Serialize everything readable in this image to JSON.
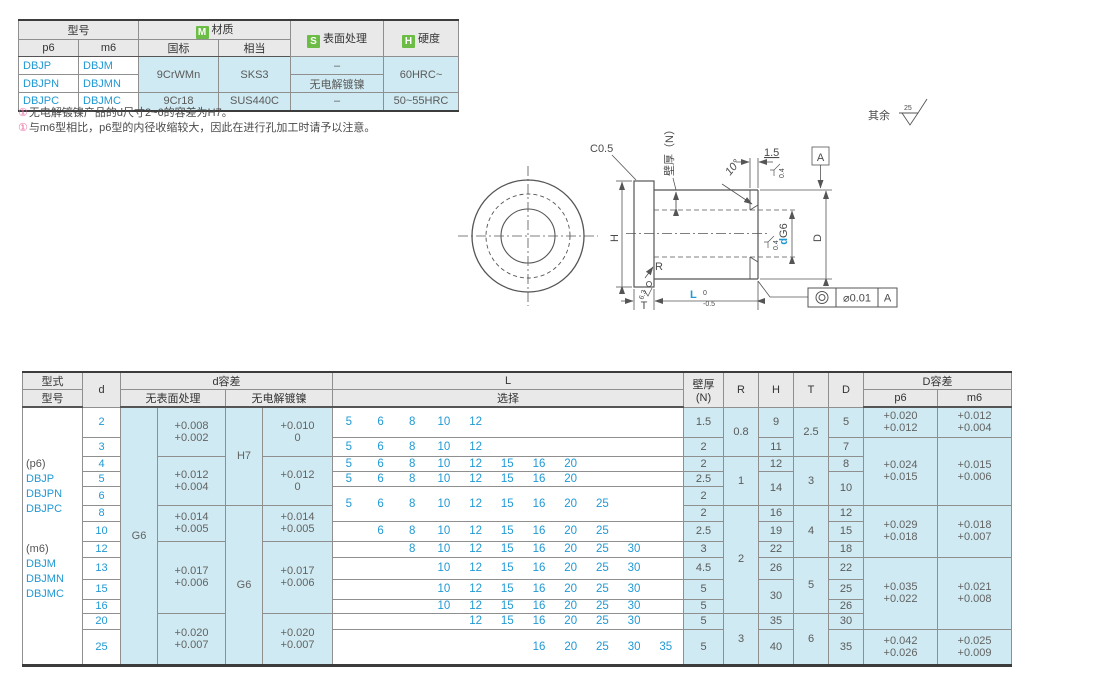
{
  "top_table": {
    "headers": {
      "model": "型号",
      "p6": "p6",
      "m6": "m6",
      "material_badge": "M",
      "material": "材质",
      "gb": "国标",
      "equiv": "相当",
      "surface_badge": "S",
      "surface": "表面处理",
      "hardness_badge": "H",
      "hardness": "硬度"
    },
    "rows": [
      {
        "p6": "DBJP",
        "m6": "DBJM",
        "gb": "9CrWMn",
        "equiv": "SKS3",
        "surface": "–",
        "hardness": "60HRC~"
      },
      {
        "p6": "DBJPN",
        "m6": "DBJMN",
        "surface": "无电解镀镍"
      },
      {
        "p6": "DBJPC",
        "m6": "DBJMC",
        "gb": "9Cr18",
        "equiv": "SUS440C",
        "surface": "–",
        "hardness": "50~55HRC"
      }
    ]
  },
  "notes": [
    {
      "marker": "①",
      "text": "无电解镀镍产品的d尺寸2~6的容差为H7。"
    },
    {
      "marker": "①",
      "text": "与m6型相比，p6型的内径收缩较大，因此在进行孔加工时请予以注意。"
    }
  ],
  "drawing": {
    "labels": {
      "chamfer": "C0.5",
      "wall": "壁厚（N）",
      "angle": "10°",
      "land": "1.5",
      "datum": "A",
      "surface_top": "0.4",
      "surface_bore": "0.4",
      "surface_radius": "6.3",
      "bore_d": "d",
      "bore_fit": "G6",
      "od": "D",
      "height": "H",
      "radius": "R",
      "flange_t": "T",
      "length": "L",
      "length_tol_hi": "0",
      "length_tol_lo": "-0.5",
      "concentricity_value": "⌀0.01",
      "concentricity_datum": "A",
      "others": "其余",
      "others_roughness": "25"
    }
  },
  "bottom_table": {
    "header": {
      "type": "型式",
      "model": "型号",
      "d": "d",
      "d_tol": "d容差",
      "no_surface": "无表面处理",
      "electroless": "无电解镀镍",
      "L": "L",
      "select": "选择",
      "wall_line1": "壁厚",
      "wall_line2": "(N)",
      "R": "R",
      "H": "H",
      "T": "T",
      "D": "D",
      "D_tol": "D容差",
      "p6": "p6",
      "m6": "m6"
    },
    "model_p6": [
      "(p6)",
      "DBJP",
      "DBJPN",
      "DBJPC"
    ],
    "model_m6": [
      "(m6)",
      "DBJM",
      "DBJMN",
      "DBJMC"
    ],
    "d": [
      "2",
      "3",
      "4",
      "5",
      "6",
      "8",
      "10",
      "12",
      "13",
      "15",
      "16",
      "20",
      "25"
    ],
    "grade_no_surface": "G6",
    "grade_electroless_small": "H7",
    "grade_electroless_large": "G6",
    "tol_no_surface": [
      {
        "hi": "+0.008",
        "lo": "+0.002"
      },
      {
        "hi": "+0.012",
        "lo": "+0.004"
      },
      {
        "hi": "+0.014",
        "lo": "+0.005"
      },
      {
        "hi": "+0.017",
        "lo": "+0.006"
      },
      {
        "hi": "+0.020",
        "lo": "+0.007"
      }
    ],
    "tol_electroless": [
      {
        "hi": "+0.010",
        "lo": "0"
      },
      {
        "hi": "+0.012",
        "lo": "0"
      },
      {
        "hi": "+0.014",
        "lo": "+0.005"
      },
      {
        "hi": "+0.017",
        "lo": "+0.006"
      },
      {
        "hi": "+0.020",
        "lo": "+0.007"
      }
    ],
    "L": [
      [
        "5",
        "6",
        "8",
        "10",
        "12"
      ],
      [
        "5",
        "6",
        "8",
        "10",
        "12"
      ],
      [
        "5",
        "6",
        "8",
        "10",
        "12",
        "15",
        "16",
        "20"
      ],
      [
        "5",
        "6",
        "8",
        "10",
        "12",
        "15",
        "16",
        "20"
      ],
      [
        "5",
        "6",
        "8",
        "10",
        "12",
        "15",
        "16",
        "20",
        "25"
      ],
      [
        "6",
        "8",
        "10",
        "12",
        "15",
        "16",
        "20",
        "25"
      ],
      [
        "8",
        "10",
        "12",
        "15",
        "16",
        "20",
        "25",
        "30"
      ],
      [
        "10",
        "12",
        "15",
        "16",
        "20",
        "25",
        "30"
      ],
      [
        "10",
        "12",
        "15",
        "16",
        "20",
        "25",
        "30"
      ],
      [
        "10",
        "12",
        "15",
        "16",
        "20",
        "25",
        "30"
      ],
      [
        "12",
        "15",
        "16",
        "20",
        "25",
        "30"
      ],
      [
        "16",
        "20",
        "25",
        "30",
        "35"
      ]
    ],
    "N": [
      "1.5",
      "2",
      "2",
      "2.5",
      "2",
      "2",
      "2.5",
      "3",
      "4.5",
      "5",
      "5",
      "5",
      "5"
    ],
    "R": [
      "0.8",
      "1",
      "2",
      "3"
    ],
    "H": [
      "9",
      "11",
      "12",
      "14",
      "16",
      "19",
      "22",
      "26",
      "30",
      "35",
      "40"
    ],
    "T": [
      "2.5",
      "3",
      "4",
      "5",
      "6"
    ],
    "D": [
      "5",
      "7",
      "8",
      "10",
      "12",
      "15",
      "18",
      "22",
      "25",
      "26",
      "30",
      "35"
    ],
    "tol_p6": [
      {
        "hi": "+0.020",
        "lo": "+0.012"
      },
      {
        "hi": "+0.024",
        "lo": "+0.015"
      },
      {
        "hi": "+0.029",
        "lo": "+0.018"
      },
      {
        "hi": "+0.035",
        "lo": "+0.022"
      },
      {
        "hi": "+0.042",
        "lo": "+0.026"
      }
    ],
    "tol_m6": [
      {
        "hi": "+0.012",
        "lo": "+0.004"
      },
      {
        "hi": "+0.015",
        "lo": "+0.006"
      },
      {
        "hi": "+0.018",
        "lo": "+0.007"
      },
      {
        "hi": "+0.021",
        "lo": "+0.008"
      },
      {
        "hi": "+0.025",
        "lo": "+0.009"
      }
    ]
  }
}
